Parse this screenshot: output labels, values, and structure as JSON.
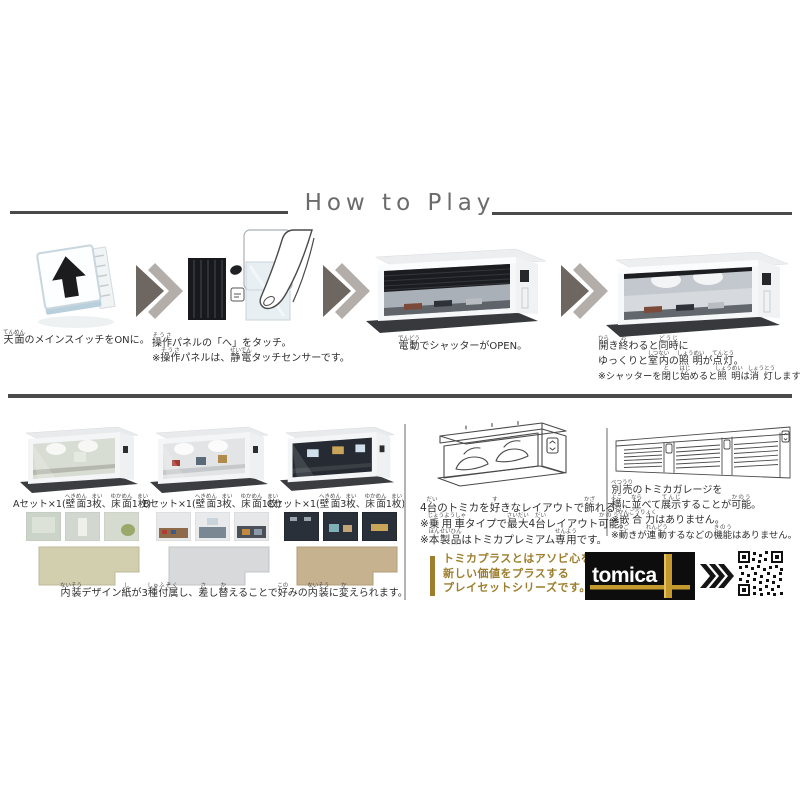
{
  "title": "How to Play",
  "colors": {
    "gold_text": "#9c7e2c",
    "gold_brand": "#c49a2e",
    "body_text": "#333333",
    "title_text": "#6b6b6b",
    "rule": "#4a4a4a"
  },
  "steps": {
    "step1": {
      "caption": [
        {
          "t": "天面",
          "r": "てんめん"
        },
        {
          "t": "のメインスイッチをONに。"
        }
      ]
    },
    "step2": {
      "line1": [
        {
          "t": "操作",
          "r": "そうさ"
        },
        {
          "t": "パネルの「へ」をタッチ。"
        }
      ],
      "line2": [
        {
          "t": "※"
        },
        {
          "t": "操作",
          "r": "そうさ"
        },
        {
          "t": "パネルは、"
        },
        {
          "t": "静電",
          "r": "せいでん"
        },
        {
          "t": "タッチセンサーです。"
        }
      ]
    },
    "step3": {
      "caption": [
        {
          "t": "電動",
          "r": "でんどう"
        },
        {
          "t": "でシャッターがOPEN。"
        }
      ]
    },
    "step4": {
      "line1": [
        {
          "t": "開",
          "r": "ひら"
        },
        {
          "t": "き"
        },
        {
          "t": "終",
          "r": "お"
        },
        {
          "t": "わると"
        },
        {
          "t": "同時",
          "r": "どうじ"
        },
        {
          "t": "に"
        }
      ],
      "line2": [
        {
          "t": "ゆっくりと"
        },
        {
          "t": "室内",
          "r": "しつない"
        },
        {
          "t": "の"
        },
        {
          "t": "照明",
          "r": "しょうめい"
        },
        {
          "t": "が"
        },
        {
          "t": "点灯",
          "r": "てんとう"
        },
        {
          "t": "。"
        }
      ],
      "line3": [
        {
          "t": "※シャッターを"
        },
        {
          "t": "閉",
          "r": "と"
        },
        {
          "t": "じ"
        },
        {
          "t": "始",
          "r": "はじ"
        },
        {
          "t": "めると"
        },
        {
          "t": "照明",
          "r": "しょうめい"
        },
        {
          "t": "は"
        },
        {
          "t": "消灯",
          "r": "しょうとう"
        },
        {
          "t": "します。"
        }
      ]
    }
  },
  "sets": {
    "a": {
      "label": [
        {
          "t": "Aセット×1("
        },
        {
          "t": "壁面",
          "r": "へきめん"
        },
        {
          "t": "3"
        },
        {
          "t": "枚",
          "r": "まい"
        },
        {
          "t": "、"
        },
        {
          "t": "床面",
          "r": "ゆかめん"
        },
        {
          "t": "1"
        },
        {
          "t": "枚",
          "r": "まい"
        },
        {
          "t": ")"
        }
      ]
    },
    "b": {
      "label": [
        {
          "t": "Bセット×1("
        },
        {
          "t": "壁面",
          "r": "へきめん"
        },
        {
          "t": "3"
        },
        {
          "t": "枚",
          "r": "まい"
        },
        {
          "t": "、"
        },
        {
          "t": "床面",
          "r": "ゆかめん"
        },
        {
          "t": "1"
        },
        {
          "t": "枚",
          "r": "まい"
        },
        {
          "t": ")"
        }
      ]
    },
    "c": {
      "label": [
        {
          "t": "Cセット×1("
        },
        {
          "t": "壁面",
          "r": "へきめん"
        },
        {
          "t": "3"
        },
        {
          "t": "枚",
          "r": "まい"
        },
        {
          "t": "、"
        },
        {
          "t": "床面",
          "r": "ゆかめん"
        },
        {
          "t": "1"
        },
        {
          "t": "枚",
          "r": "まい"
        },
        {
          "t": ")"
        }
      ]
    },
    "note": [
      {
        "t": "内装",
        "r": "ないそう"
      },
      {
        "t": "デザイン"
      },
      {
        "t": "紙",
        "r": "し"
      },
      {
        "t": "が3"
      },
      {
        "t": "種",
        "r": "しゅ"
      },
      {
        "t": "付属",
        "r": "ふぞく"
      },
      {
        "t": "し、"
      },
      {
        "t": "差",
        "r": "さ"
      },
      {
        "t": "し"
      },
      {
        "t": "替",
        "r": "か"
      },
      {
        "t": "えることで"
      },
      {
        "t": "好",
        "r": "この"
      },
      {
        "t": "みの"
      },
      {
        "t": "内装",
        "r": "ないそう"
      },
      {
        "t": "に"
      },
      {
        "t": "変",
        "r": "か"
      },
      {
        "t": "えられます。"
      }
    ]
  },
  "layout_info": {
    "line1": [
      {
        "t": "4"
      },
      {
        "t": "台",
        "r": "だい"
      },
      {
        "t": "のトミカを"
      },
      {
        "t": "好",
        "r": "す"
      },
      {
        "t": "きなレイアウトで"
      },
      {
        "t": "飾",
        "r": "かざ"
      },
      {
        "t": "れる。"
      }
    ],
    "line2": [
      {
        "t": "※"
      },
      {
        "t": "乗用車",
        "r": "じょうようしゃ"
      },
      {
        "t": "タイプで"
      },
      {
        "t": "最大",
        "r": "さいだい"
      },
      {
        "t": "4"
      },
      {
        "t": "台",
        "r": "だい"
      },
      {
        "t": "レイアウト"
      },
      {
        "t": "可能",
        "r": "かのう"
      },
      {
        "t": "。"
      }
    ],
    "line3": [
      {
        "t": "※"
      },
      {
        "t": "本製品",
        "r": "ほんせいひん"
      },
      {
        "t": "はトミカプレミアム"
      },
      {
        "t": "専用",
        "r": "せんよう"
      },
      {
        "t": "です。"
      }
    ]
  },
  "display_info": {
    "line1": [
      {
        "t": "別売",
        "r": "べつうり"
      },
      {
        "t": "のトミカガレージを"
      }
    ],
    "line2": [
      {
        "t": "横",
        "r": "よこ"
      },
      {
        "t": "に"
      },
      {
        "t": "並",
        "r": "なら"
      },
      {
        "t": "べて"
      },
      {
        "t": "展示",
        "r": "てんじ"
      },
      {
        "t": "することが"
      },
      {
        "t": "可能",
        "r": "かのう"
      },
      {
        "t": "。"
      }
    ],
    "line3": [
      {
        "t": "※"
      },
      {
        "t": "嵌合力",
        "r": "かんごうりょく"
      },
      {
        "t": "はありません。"
      }
    ],
    "line4": [
      {
        "t": "※"
      },
      {
        "t": "動",
        "r": "うご"
      },
      {
        "t": "きが"
      },
      {
        "t": "連動",
        "r": "れんどう"
      },
      {
        "t": "するなどの"
      },
      {
        "t": "機能",
        "r": "きのう"
      },
      {
        "t": "はありません。"
      }
    ]
  },
  "tomica_plus": {
    "line1": "トミカプラスとはアソビ心を持った",
    "line2": "新しい価値をプラスする",
    "line3": "プレイセットシリーズです。"
  },
  "brand": {
    "logo_text": "tomica"
  }
}
